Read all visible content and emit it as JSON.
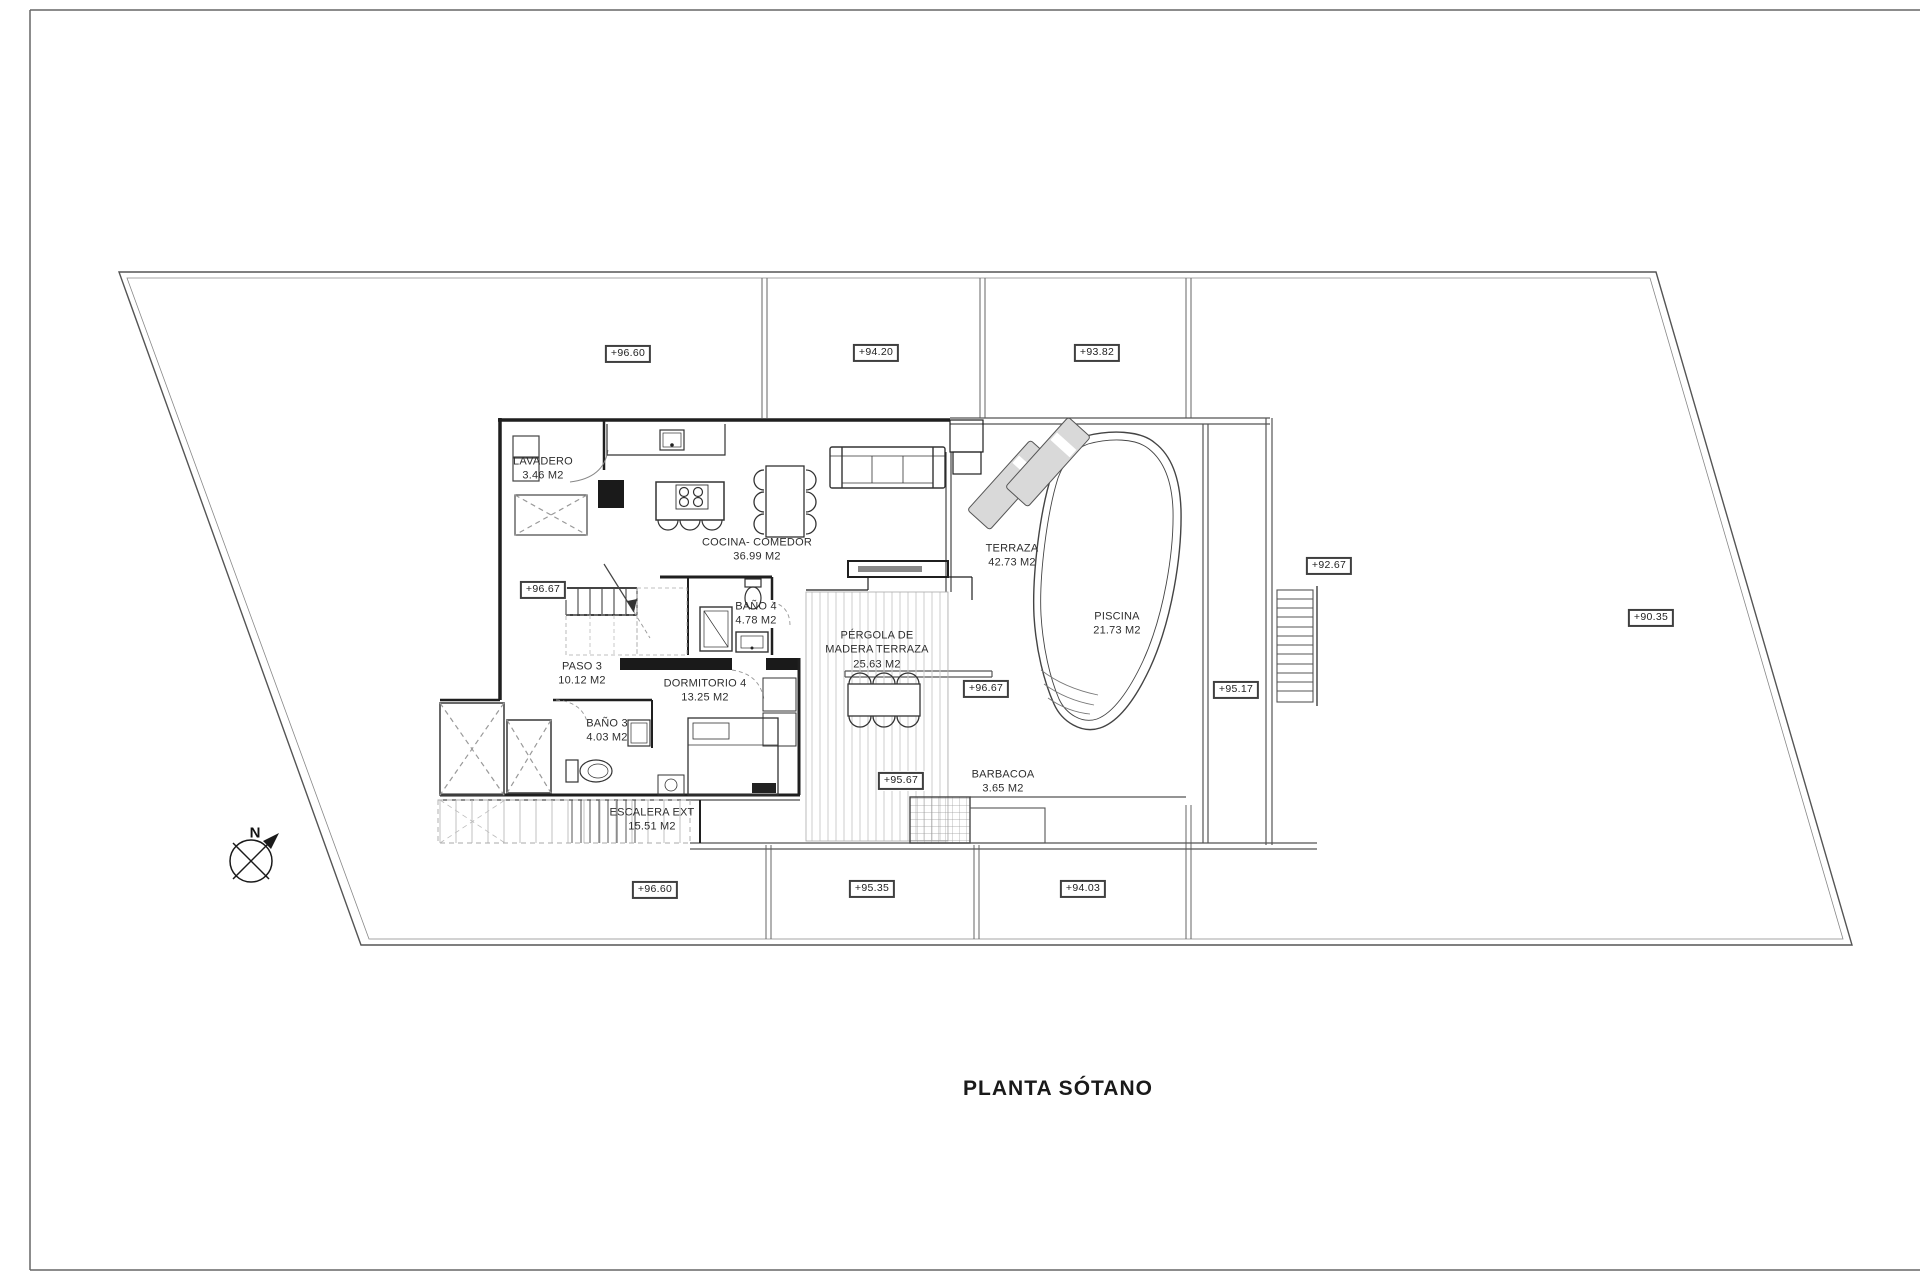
{
  "title": "PLANTA SÓTANO",
  "compass": {
    "label": "N"
  },
  "rooms": {
    "lavadero": {
      "name": "LAVADERO",
      "area": "3.46 M2"
    },
    "cocina": {
      "name": "COCINA- COMEDOR",
      "area": "36.99 M2"
    },
    "paso3": {
      "name": "PASO 3",
      "area": "10.12 M2"
    },
    "bano4": {
      "name": "BAÑO 4",
      "area": "4.78 M2"
    },
    "dormitorio4": {
      "name": "DORMITORIO 4",
      "area": "13.25 M2"
    },
    "bano3": {
      "name": "BAÑO 3",
      "area": "4.03 M2"
    },
    "escalera_ext": {
      "name": "ESCALERA EXT",
      "area": "15.51 M2"
    },
    "pergola": {
      "name": "PÉRGOLA DE MADERA TERRAZA",
      "area": "25.63 M2"
    },
    "terraza": {
      "name": "TERRAZA",
      "area": "42.73 M2"
    },
    "piscina": {
      "name": "PISCINA",
      "area": "21.73 M2"
    },
    "barbacoa": {
      "name": "BARBACOA",
      "area": "3.65 M2"
    }
  },
  "elevations": {
    "top_left": "+96.60",
    "top_mid": "+94.20",
    "top_right": "+93.82",
    "entry": "+96.67",
    "terrace_mid": "+96.67",
    "pergola_low": "+95.67",
    "bottom_left": "+96.60",
    "bottom_mid": "+95.35",
    "bottom_right": "+94.03",
    "stair_top": "+92.67",
    "stair_low": "+95.17",
    "plot_east": "+90.35"
  },
  "colors": {
    "line": "#2b2b2b",
    "light_line": "#999999",
    "furniture_fill": "#d9d9d9"
  }
}
